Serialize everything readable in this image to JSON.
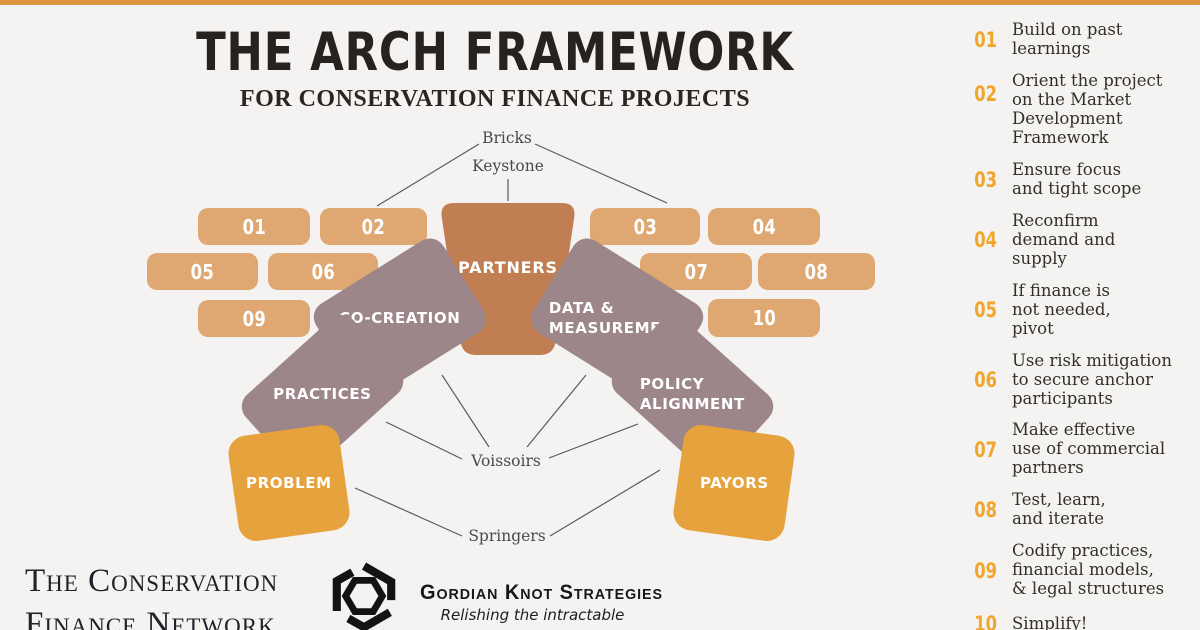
{
  "colors": {
    "background": "#f4f3f1",
    "accent_bar": "#df953f",
    "brick": "#dfa873",
    "keystone": "#c07e52",
    "voussoir": "#9d8689",
    "springer": "#e6a23c",
    "step_number": "#f0a62b",
    "text_dark": "#2b2523"
  },
  "header": {
    "title": "THE ARCH FRAMEWORK",
    "subtitle": "FOR CONSERVATION FINANCE PROJECTS"
  },
  "diagram": {
    "labels": {
      "bricks": "Bricks",
      "keystone": "Keystone",
      "voissoirs": "Voissoirs",
      "springers": "Springers"
    },
    "bricks": [
      {
        "label": "01"
      },
      {
        "label": "02"
      },
      {
        "label": "03"
      },
      {
        "label": "04"
      },
      {
        "label": "05"
      },
      {
        "label": "06"
      },
      {
        "label": "07"
      },
      {
        "label": "08"
      },
      {
        "label": "09"
      },
      {
        "label": "10"
      }
    ],
    "stones": {
      "keystone": {
        "label": "PARTNERS"
      },
      "co_creation": {
        "label": "CO-CREATION"
      },
      "data_measurement": {
        "label": "DATA &\nMEASUREMENT"
      },
      "practices": {
        "label": "PRACTICES"
      },
      "policy_alignment": {
        "label": "POLICY\nALIGNMENT"
      },
      "problem": {
        "label": "PROBLEM"
      },
      "payors": {
        "label": "PAYORS"
      }
    }
  },
  "sidebar": {
    "items": [
      {
        "num": "01",
        "text": "Build on past\nlearnings"
      },
      {
        "num": "02",
        "text": "Orient the project\non the Market\nDevelopment\nFramework"
      },
      {
        "num": "03",
        "text": "Ensure focus\nand tight scope"
      },
      {
        "num": "04",
        "text": "Reconfirm\ndemand and\nsupply"
      },
      {
        "num": "05",
        "text": "If finance is\nnot needed,\npivot"
      },
      {
        "num": "06",
        "text": "Use risk mitigation\nto secure anchor\nparticipants"
      },
      {
        "num": "07",
        "text": "Make effective\nuse of commercial\npartners"
      },
      {
        "num": "08",
        "text": "Test, learn,\nand iterate"
      },
      {
        "num": "09",
        "text": "Codify practices,\nfinancial models,\n& legal structures"
      },
      {
        "num": "10",
        "text": "Simplify!"
      }
    ]
  },
  "footer": {
    "cfn": {
      "line1": "The Conservation",
      "line2": "Finance Network"
    },
    "gks": {
      "name": "Gordian Knot Strategies",
      "tagline": "Relishing the intractable"
    }
  }
}
